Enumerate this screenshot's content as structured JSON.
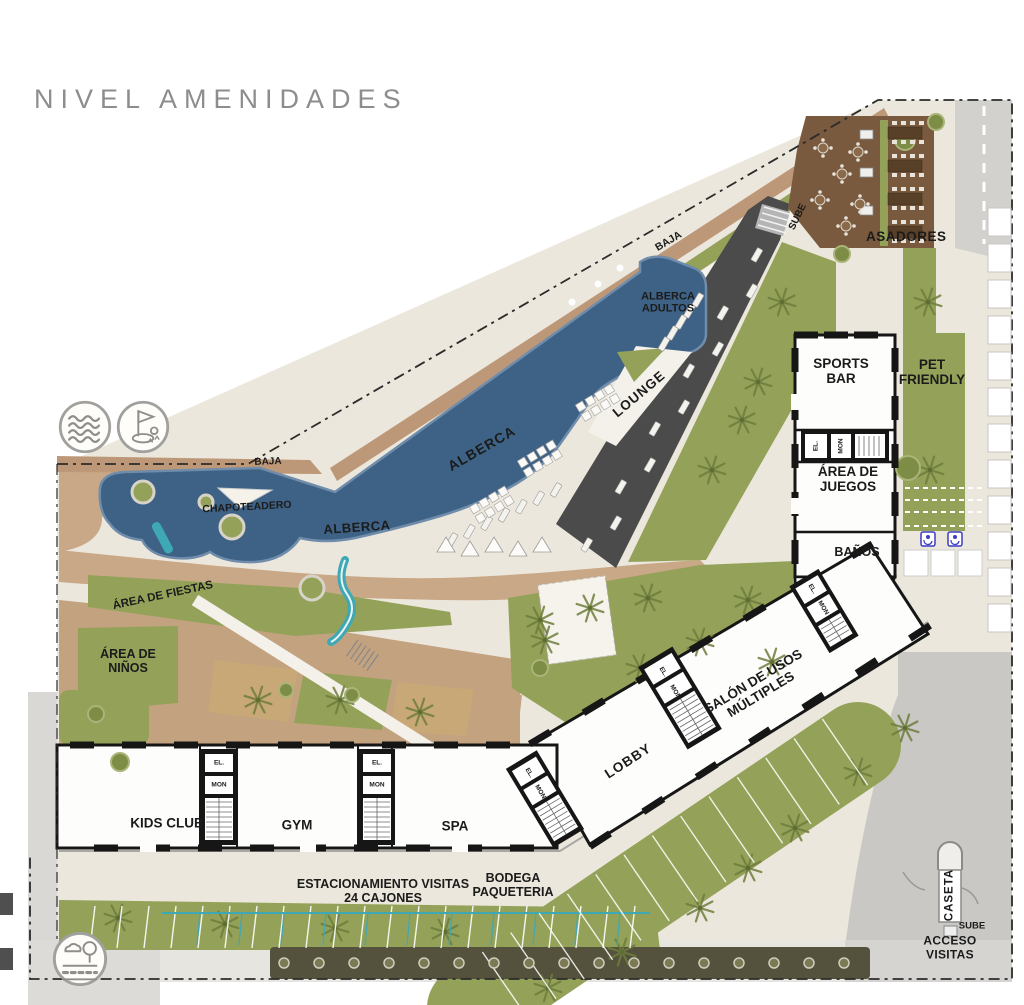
{
  "title": "NIVEL AMENIDADES",
  "plan": {
    "areas": {
      "baja_upper": "BAJA",
      "sube_upper": "SUBE",
      "asadores": "ASADORES",
      "alberca_adultos": "ALBERCA\nADULTOS",
      "lounge": "LOUNGE",
      "sports_bar": "SPORTS\nBAR",
      "pet_friendly": "PET\nFRIENDLY",
      "area_de_juegos": "ÁREA DE\nJUEGOS",
      "banos": "BAÑOS",
      "alberca_upper": "ALBERCA",
      "alberca_lower": "ALBERCA",
      "baja_west": "BAJA",
      "chapoteadero": "CHAPOTEADERO",
      "area_de_fiestas": "ÁREA DE FIESTAS",
      "area_de_ninos": "ÁREA DE\nNIÑOS",
      "salon_usos": "SALÓN DE USOS\nMÚLTIPLES",
      "lobby": "LOBBY",
      "kids_club": "KIDS CLUB",
      "gym": "GYM",
      "spa": "SPA",
      "estacionamiento": "ESTACIONAMIENTO VISITAS\n24 CAJONES",
      "bodega": "BODEGA\nPAQUETERIA",
      "caseta": "CASETA",
      "sube_lower": "SUBE",
      "acceso_visitas": "ACCESO VISITAS",
      "elevator": "EL.",
      "montacargas": "MON"
    },
    "legend_icons": {
      "water": "waves-icon",
      "golf": "golf-flag-icon",
      "road": "road-landscape-icon"
    }
  },
  "colors": {
    "pool": "#3e6285",
    "pool_edge": "#6f8cab",
    "green": "#94a259",
    "green_dark": "#75853f",
    "tan": "#bd9878",
    "deck_tan": "#c9a887",
    "terrace_tan": "#c3a27f",
    "brown_deck": "#7a5a3e",
    "table_brown": "#573f28",
    "dark_road": "#4b4b4b",
    "paving": "#ece7dc",
    "road_gray": "#d2d1cd",
    "road_gray2": "#c9c8c4",
    "wall": "#161616",
    "teal": "#3fa8b5",
    "accent_blue": "#3d3dc2",
    "title_gray": "#8d8d8d",
    "strip_dark": "#54523c"
  }
}
